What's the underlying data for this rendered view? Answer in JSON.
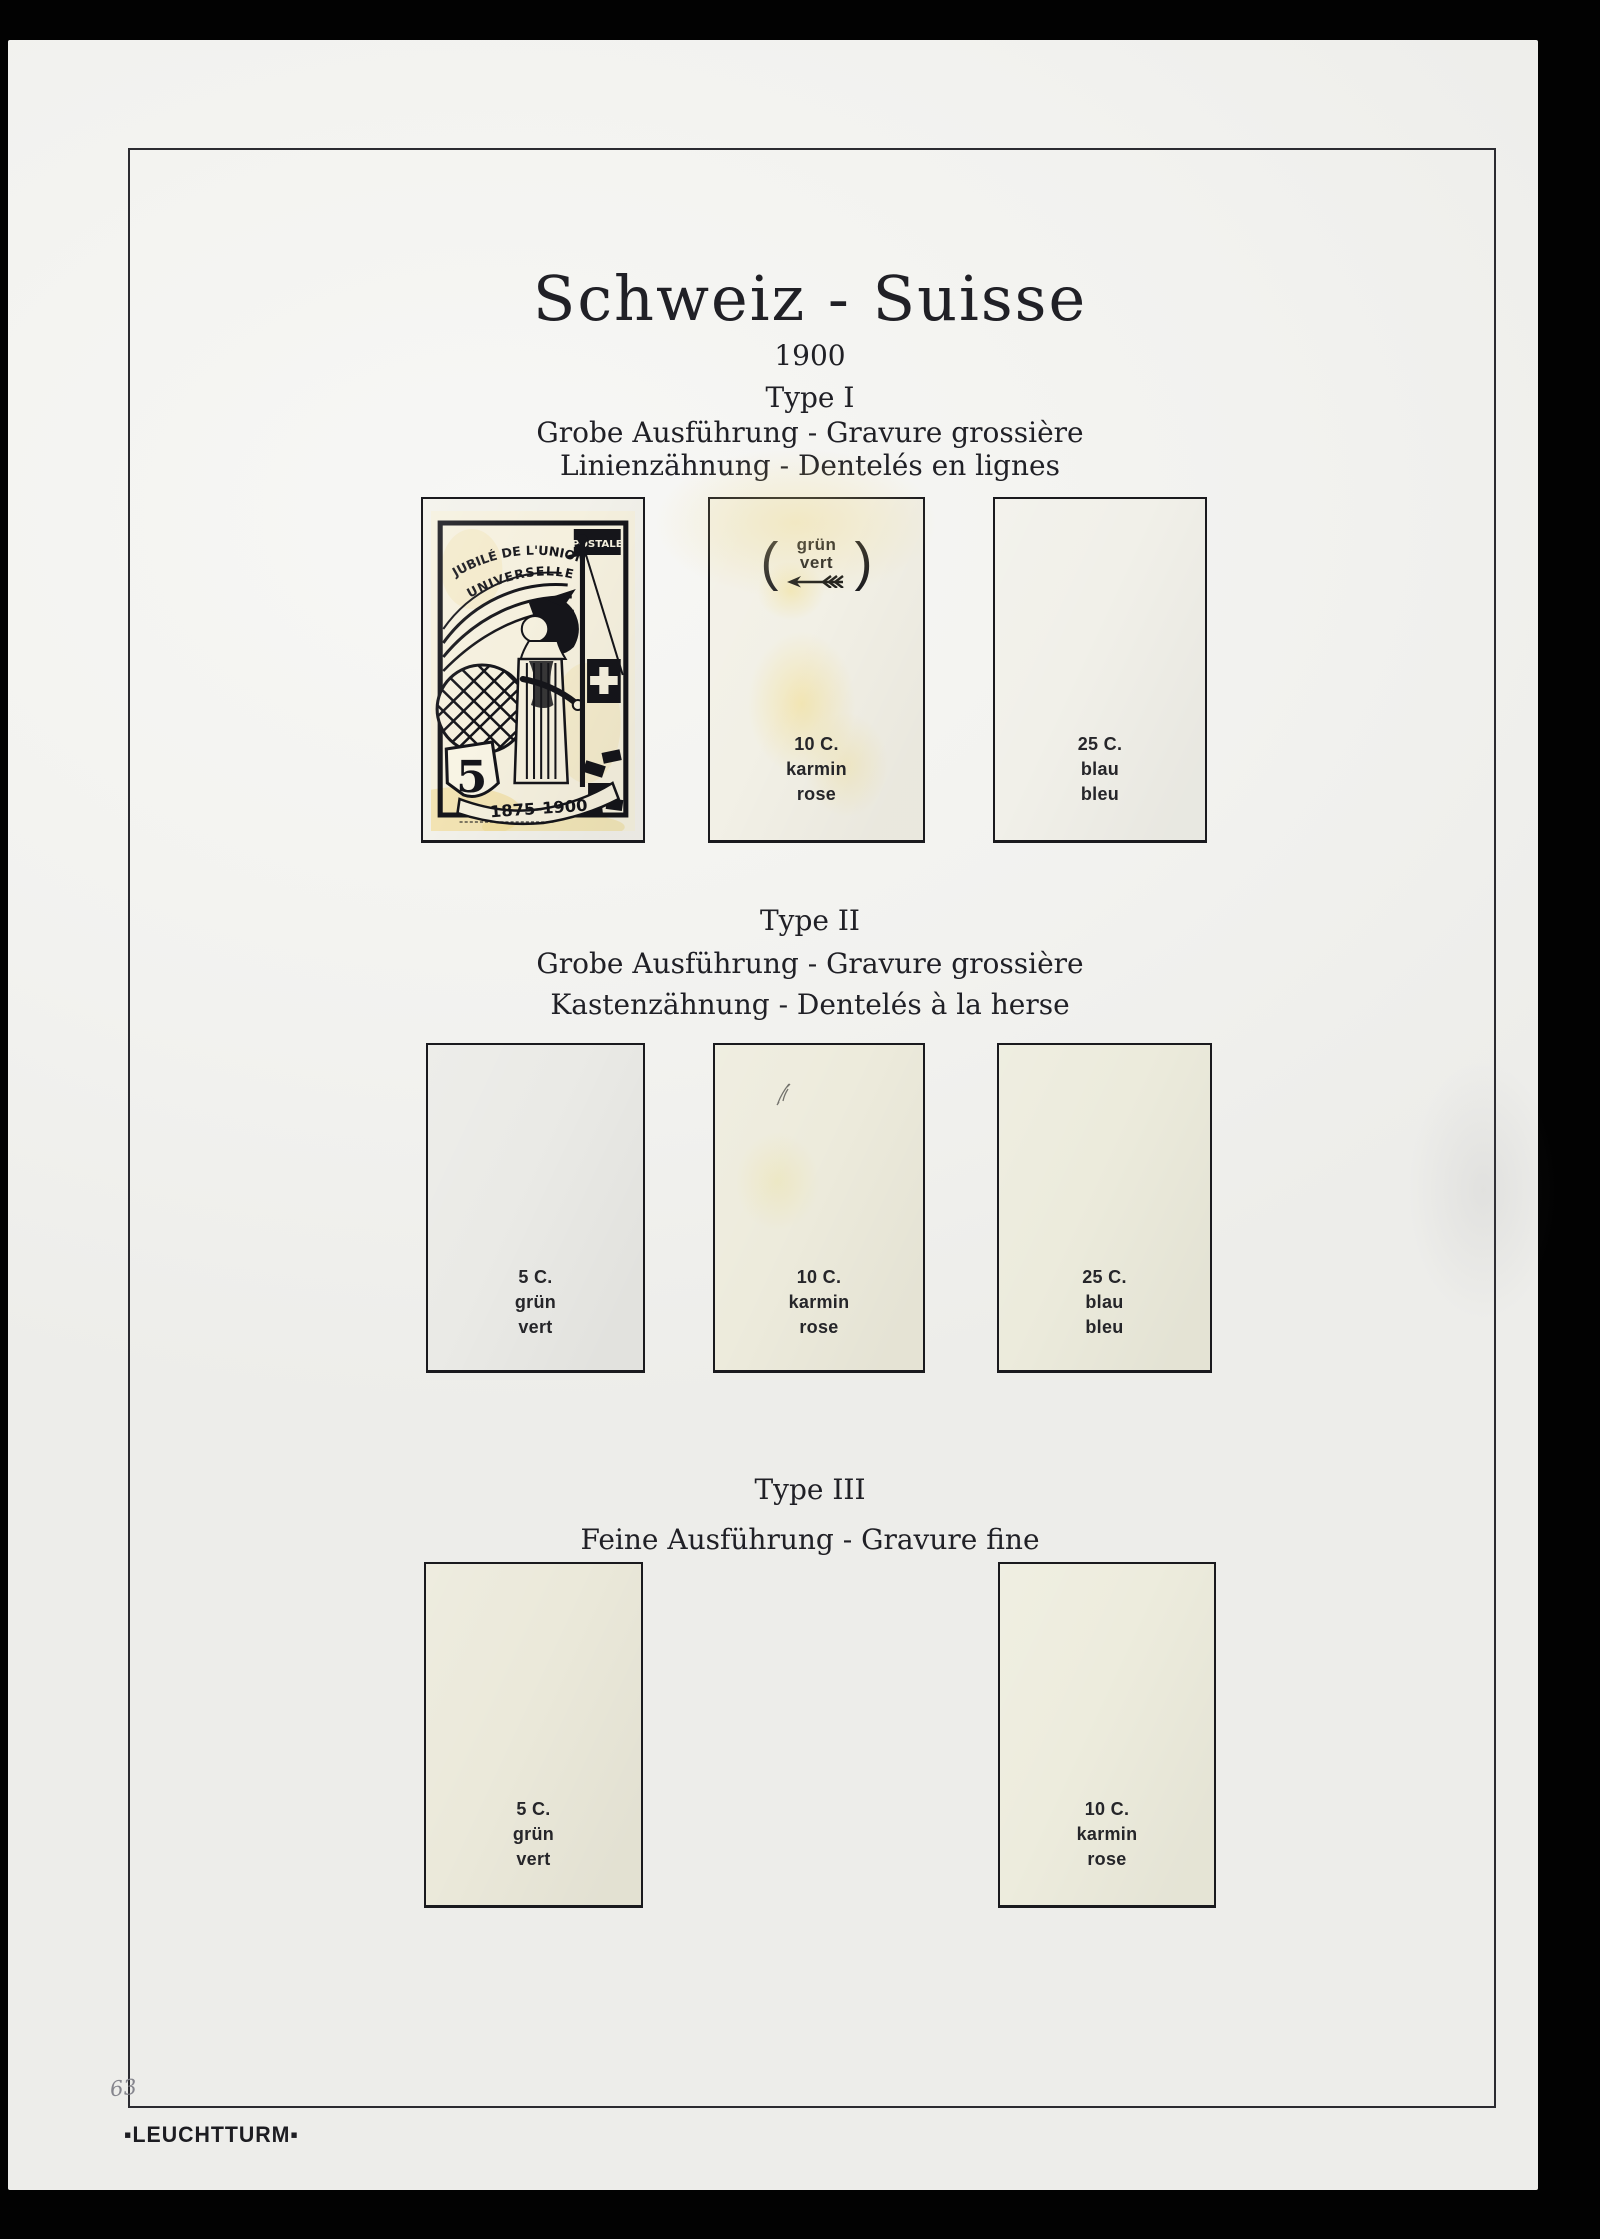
{
  "page": {
    "title": "Schweiz - Suisse",
    "year": "1900",
    "publisher": "▪LEUCHTTURM▪",
    "pencil_note": "63",
    "paper_color": "#f2f2ef",
    "background_color": "#020202"
  },
  "sections": [
    {
      "type_label": "Type I",
      "line1": "Grobe Ausführung - Gravure grossière",
      "line2": "Linienzähnung - Dentelés en lignes",
      "slots": [
        {
          "kind": "stamp",
          "stamp": {
            "top_arc_line1": "JUBILÉ DE L'UNION",
            "top_arc_line2": "UNIVERSELLE",
            "top_right": "POSTALE",
            "denomination": "5",
            "banner": "1875-1900"
          }
        },
        {
          "kind": "empty",
          "indicator": {
            "open": "(",
            "word_de": "grün",
            "word_fr": "vert",
            "close": ")"
          },
          "value": "10 C.",
          "color_de": "karmin",
          "color_fr": "rose"
        },
        {
          "kind": "empty",
          "value": "25 C.",
          "color_de": "blau",
          "color_fr": "bleu"
        }
      ]
    },
    {
      "type_label": "Type II",
      "line1": "Grobe Ausführung - Gravure grossière",
      "line2": "Kastenzähnung - Dentelés à la herse",
      "slots": [
        {
          "kind": "empty",
          "value": "5 C.",
          "color_de": "grün",
          "color_fr": "vert"
        },
        {
          "kind": "empty",
          "value": "10 C.",
          "color_de": "karmin",
          "color_fr": "rose"
        },
        {
          "kind": "empty",
          "value": "25 C.",
          "color_de": "blau",
          "color_fr": "bleu"
        }
      ]
    },
    {
      "type_label": "Type III",
      "line1": "Feine Ausführung - Gravure fine",
      "slots": [
        {
          "kind": "empty",
          "value": "5 C.",
          "color_de": "grün",
          "color_fr": "vert"
        },
        {
          "kind": "empty",
          "value": "10 C.",
          "color_de": "karmin",
          "color_fr": "rose"
        }
      ]
    }
  ]
}
